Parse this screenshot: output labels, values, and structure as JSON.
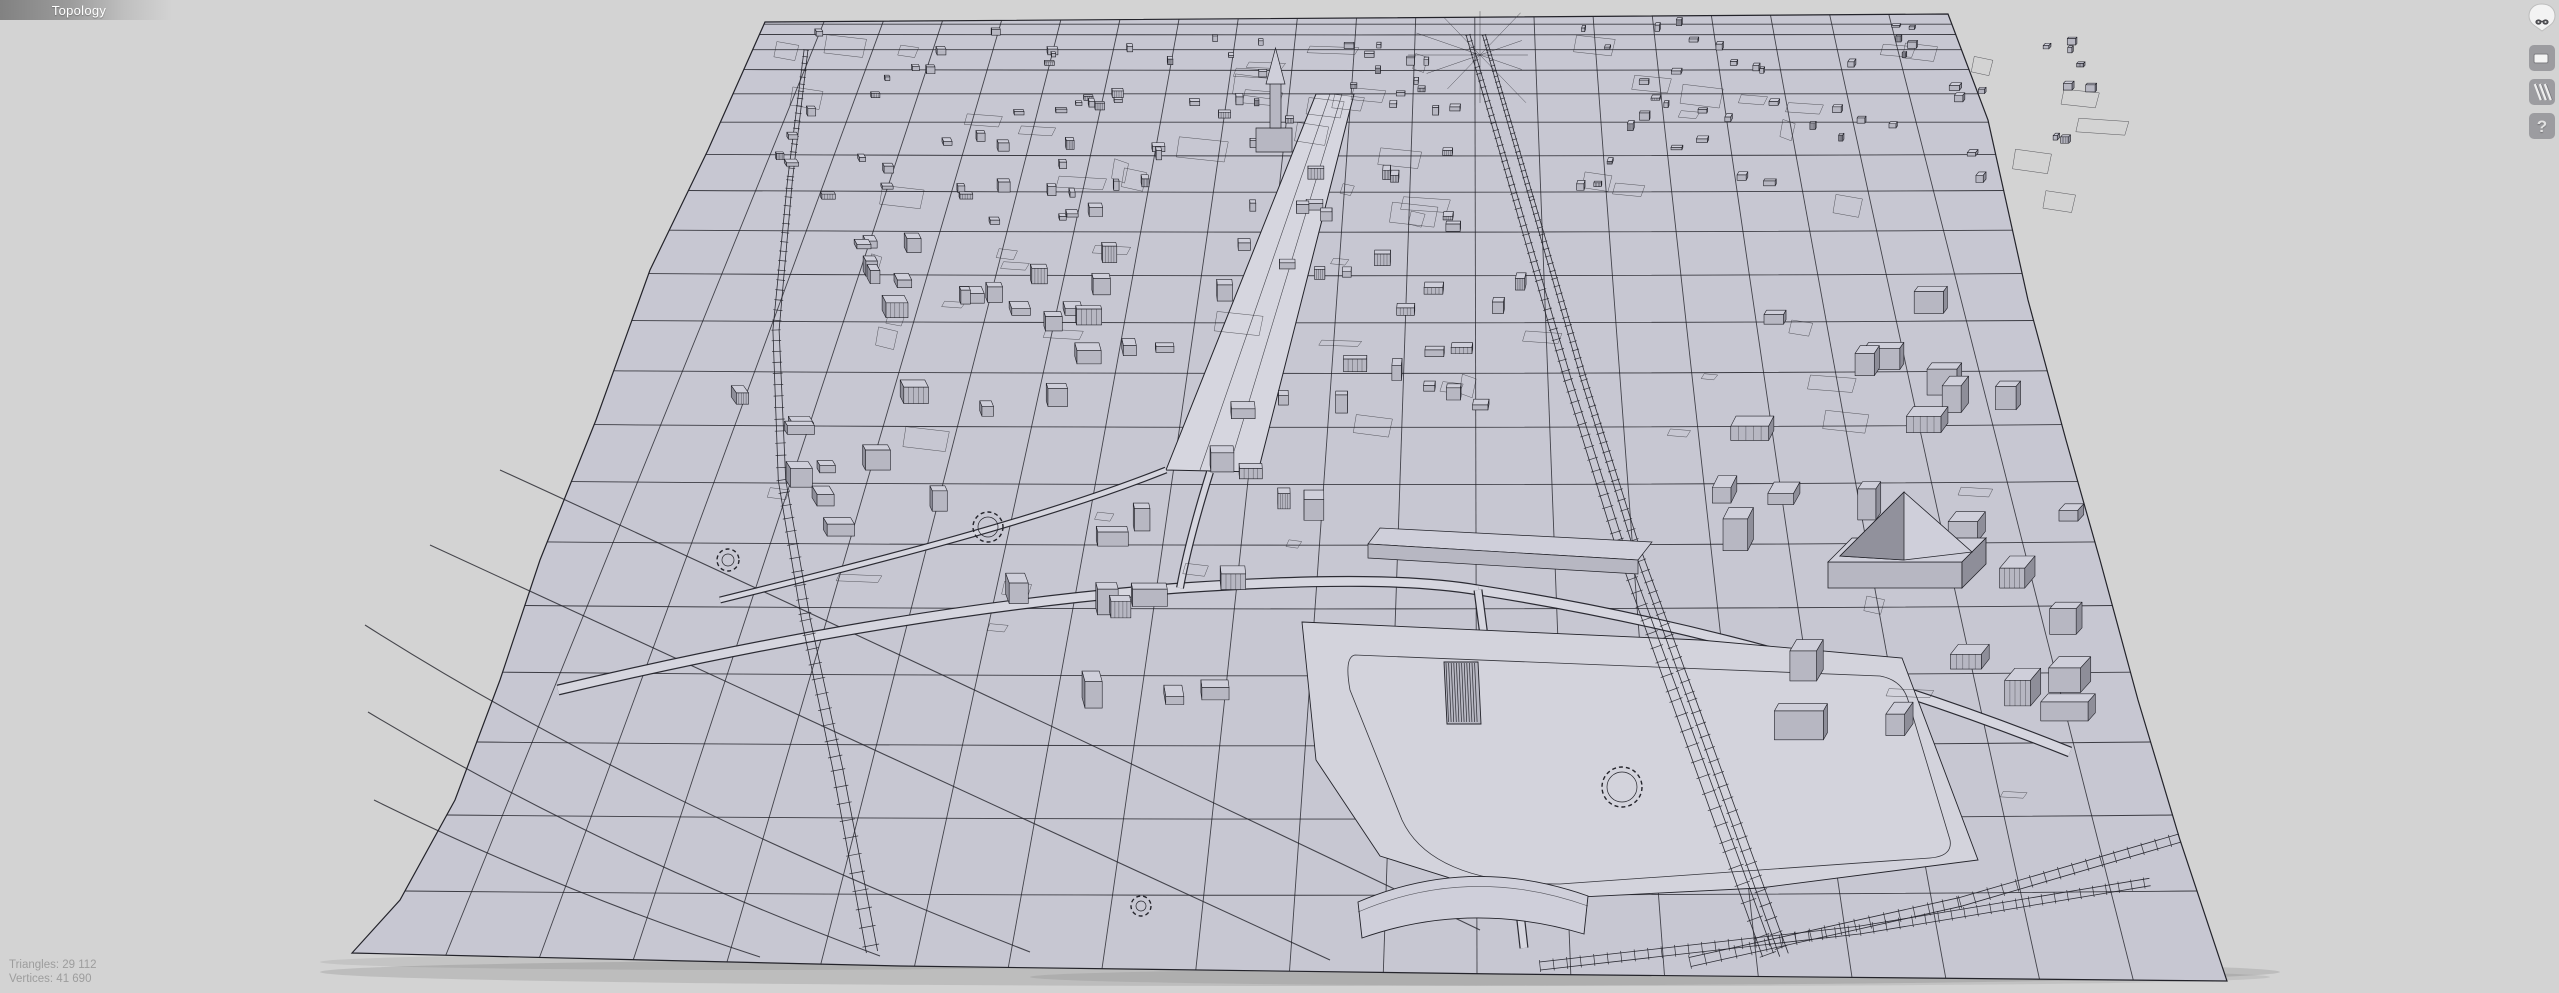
{
  "header": {
    "tab_label": "Topology"
  },
  "stats": {
    "triangles": "Triangles: 29 112",
    "vertices": "Vertices: 41 690"
  },
  "toolbar": {
    "help_glyph": "?",
    "icons": [
      "logo-icon",
      "window-icon",
      "hatch-icon",
      "help-icon"
    ]
  },
  "scene": {
    "description": "3D wireframe topology view of a city model on a terrain grid",
    "background": "#d3d3d3",
    "terrain_fill": "#c7c7d2",
    "plaza_fill": "#d3d3dc",
    "road_fill": "#d6d6df",
    "building_top": "#cfcfda",
    "building_front": "#b7b7c2",
    "building_side": "#8e8e99",
    "wire": "#23232a",
    "shadow": "#000000"
  }
}
